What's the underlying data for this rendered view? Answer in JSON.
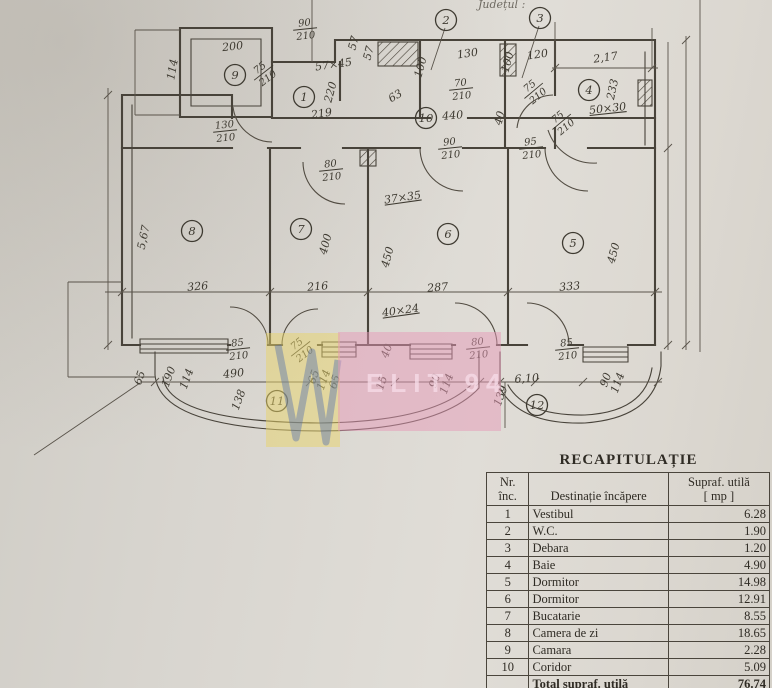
{
  "top_text": "Județul :",
  "watermark": {
    "text": "ELIT 94",
    "pink": "#e59ab8",
    "yellow": "#e8d36a",
    "blue": "#4a6ab0"
  },
  "plan": {
    "rooms": [
      {
        "n": "1",
        "x": 304,
        "y": 97
      },
      {
        "n": "2",
        "x": 446,
        "y": 20
      },
      {
        "n": "3",
        "x": 540,
        "y": 18
      },
      {
        "n": "4",
        "x": 589,
        "y": 90
      },
      {
        "n": "5",
        "x": 573,
        "y": 243
      },
      {
        "n": "6",
        "x": 448,
        "y": 234
      },
      {
        "n": "7",
        "x": 301,
        "y": 229
      },
      {
        "n": "8",
        "x": 192,
        "y": 231
      },
      {
        "n": "9",
        "x": 235,
        "y": 75
      },
      {
        "n": "10",
        "x": 426,
        "y": 118
      },
      {
        "n": "11",
        "x": 277,
        "y": 401
      },
      {
        "n": "12",
        "x": 537,
        "y": 405
      }
    ],
    "labels": [
      {
        "t": "200",
        "x": 233,
        "y": 50,
        "r": -6
      },
      {
        "t": "114",
        "x": 176,
        "y": 70,
        "r": -80
      },
      {
        "t": "57×45",
        "x": 334,
        "y": 68,
        "r": -8
      },
      {
        "t": "57",
        "x": 357,
        "y": 44,
        "r": -75
      },
      {
        "t": "57",
        "x": 372,
        "y": 54,
        "r": -75
      },
      {
        "t": "100",
        "x": 424,
        "y": 68,
        "r": -75
      },
      {
        "t": "130",
        "x": 468,
        "y": 57,
        "r": -8
      },
      {
        "t": "100",
        "x": 511,
        "y": 63,
        "r": -75
      },
      {
        "t": "120",
        "x": 538,
        "y": 58,
        "r": -8
      },
      {
        "t": "2,17",
        "x": 606,
        "y": 61,
        "r": -8
      },
      {
        "t": "233",
        "x": 616,
        "y": 90,
        "r": -78
      },
      {
        "t": "50×30",
        "x": 608,
        "y": 112,
        "r": -6,
        "u": true
      },
      {
        "t": "63",
        "x": 397,
        "y": 99,
        "r": -30
      },
      {
        "t": "219",
        "x": 322,
        "y": 117,
        "r": -8
      },
      {
        "t": "220",
        "x": 334,
        "y": 93,
        "r": -75
      },
      {
        "t": "440",
        "x": 453,
        "y": 119,
        "r": -5
      },
      {
        "t": "40",
        "x": 503,
        "y": 119,
        "r": -75
      },
      {
        "t": "5,67",
        "x": 147,
        "y": 238,
        "r": -78
      },
      {
        "t": "326",
        "x": 198,
        "y": 290,
        "r": -5
      },
      {
        "t": "400",
        "x": 329,
        "y": 245,
        "r": -75
      },
      {
        "t": "216",
        "x": 318,
        "y": 290,
        "r": -5
      },
      {
        "t": "37×35",
        "x": 403,
        "y": 201,
        "r": -8,
        "u": true
      },
      {
        "t": "450",
        "x": 391,
        "y": 258,
        "r": -75
      },
      {
        "t": "287",
        "x": 438,
        "y": 291,
        "r": -5
      },
      {
        "t": "450",
        "x": 617,
        "y": 254,
        "r": -75
      },
      {
        "t": "333",
        "x": 570,
        "y": 290,
        "r": -5
      },
      {
        "t": "40×24",
        "x": 401,
        "y": 314,
        "r": -8,
        "u": true
      },
      {
        "t": "65",
        "x": 143,
        "y": 379,
        "r": -70
      },
      {
        "t": "190",
        "x": 172,
        "y": 378,
        "r": -70
      },
      {
        "t": "114",
        "x": 190,
        "y": 380,
        "r": -70
      },
      {
        "t": "490",
        "x": 234,
        "y": 377,
        "r": -6
      },
      {
        "t": "138",
        "x": 242,
        "y": 401,
        "r": -70
      },
      {
        "t": "65",
        "x": 317,
        "y": 378,
        "r": -70
      },
      {
        "t": "114",
        "x": 327,
        "y": 381,
        "r": -70
      },
      {
        "t": "65",
        "x": 338,
        "y": 383,
        "r": -70
      },
      {
        "t": "40",
        "x": 390,
        "y": 352,
        "r": -70
      },
      {
        "t": "15",
        "x": 385,
        "y": 384,
        "r": -70
      },
      {
        "t": "90",
        "x": 438,
        "y": 382,
        "r": -70
      },
      {
        "t": "114",
        "x": 450,
        "y": 385,
        "r": -70
      },
      {
        "t": "6,10",
        "x": 527,
        "y": 382,
        "r": -4
      },
      {
        "t": "139",
        "x": 504,
        "y": 397,
        "r": -70
      },
      {
        "t": "90",
        "x": 609,
        "y": 381,
        "r": -70
      },
      {
        "t": "114",
        "x": 621,
        "y": 384,
        "r": -70
      }
    ],
    "fractions": [
      {
        "a": "90",
        "b": "210",
        "x": 305,
        "y": 28,
        "r": -6
      },
      {
        "a": "75",
        "b": "210",
        "x": 263,
        "y": 72,
        "r": -38
      },
      {
        "a": "130",
        "b": "210",
        "x": 225,
        "y": 130,
        "r": -6
      },
      {
        "a": "70",
        "b": "210",
        "x": 461,
        "y": 88,
        "r": -6
      },
      {
        "a": "75",
        "b": "210",
        "x": 533,
        "y": 90,
        "r": -40
      },
      {
        "a": "75",
        "b": "210",
        "x": 561,
        "y": 121,
        "r": -40
      },
      {
        "a": "90",
        "b": "210",
        "x": 450,
        "y": 147,
        "r": -6
      },
      {
        "a": "95",
        "b": "210",
        "x": 531,
        "y": 147,
        "r": -6
      },
      {
        "a": "80",
        "b": "210",
        "x": 331,
        "y": 169,
        "r": -6
      },
      {
        "a": "85",
        "b": "210",
        "x": 238,
        "y": 348,
        "r": -6
      },
      {
        "a": "75",
        "b": "210",
        "x": 300,
        "y": 348,
        "r": -38
      },
      {
        "a": "80",
        "b": "210",
        "x": 478,
        "y": 347,
        "r": -6
      },
      {
        "a": "85",
        "b": "210",
        "x": 567,
        "y": 348,
        "r": -6
      }
    ]
  },
  "table": {
    "title": "RECAPITULAȚIE",
    "header": {
      "col1a": "Nr.",
      "col1b": "înc.",
      "col2": "Destinație încăpere",
      "col3a": "Supraf. utilă",
      "col3b": "[ mp ]"
    },
    "rows": [
      {
        "nr": "1",
        "name": "Vestibul",
        "area": "6.28"
      },
      {
        "nr": "2",
        "name": "W.C.",
        "area": "1.90"
      },
      {
        "nr": "3",
        "name": "Debara",
        "area": "1.20"
      },
      {
        "nr": "4",
        "name": "Baie",
        "area": "4.90"
      },
      {
        "nr": "5",
        "name": "Dormitor",
        "area": "14.98"
      },
      {
        "nr": "6",
        "name": "Dormitor",
        "area": "12.91"
      },
      {
        "nr": "7",
        "name": "Bucatarie",
        "area": "8.55"
      },
      {
        "nr": "8",
        "name": "Camera de zi",
        "area": "18.65"
      },
      {
        "nr": "9",
        "name": "Camara",
        "area": "2.28"
      },
      {
        "nr": "10",
        "name": "Coridor",
        "area": "5.09"
      },
      {
        "nr": "",
        "name": "Total supraf. utilă",
        "area": "76.74",
        "total": true
      }
    ]
  }
}
